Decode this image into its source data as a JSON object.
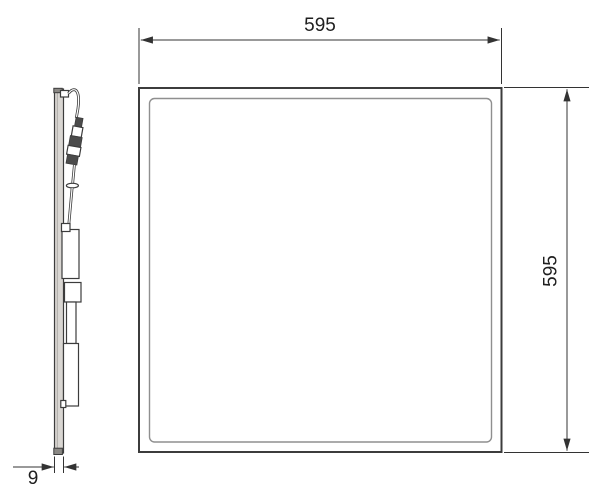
{
  "diagram": {
    "dimensions": {
      "width_label": "595",
      "height_label": "595",
      "thickness_label": "9"
    },
    "colors": {
      "background": "#ffffff",
      "outline": "#3c3c3c",
      "inner_frame": "#8f8f8f",
      "dimension": "#333333",
      "profile_fill": "#d9d6d2",
      "connector_dark": "#4b4b4b"
    }
  }
}
